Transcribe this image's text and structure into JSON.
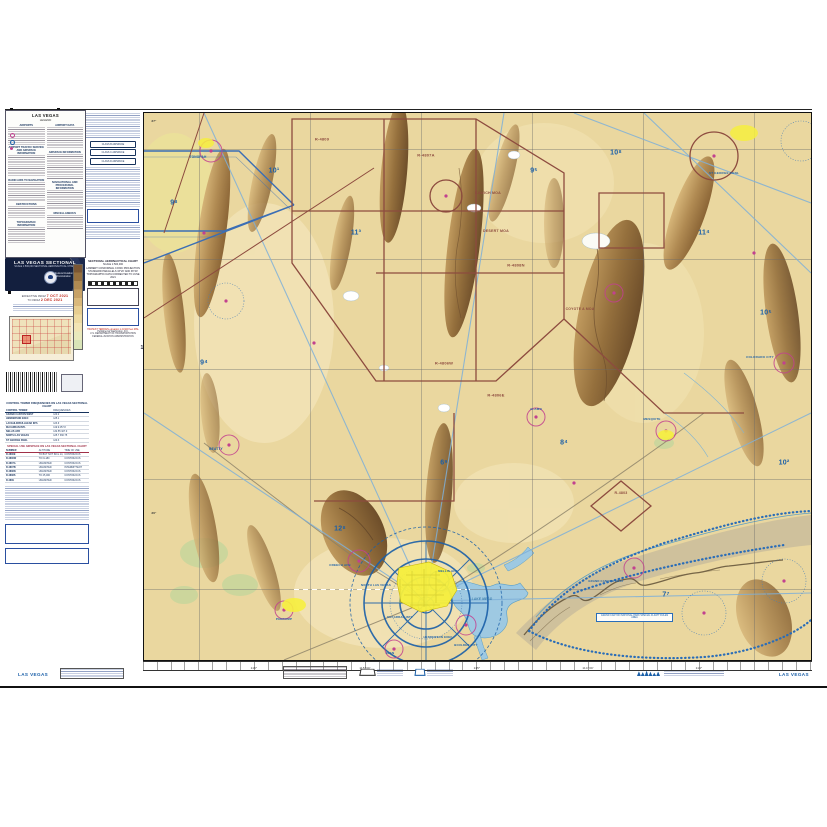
{
  "colors": {
    "maroon": "#8d4b3f",
    "blue": "#1a5fa8",
    "magenta": "#c2418f",
    "water": "#3e7fae",
    "navy": "#131f3e",
    "red": "#c22a1e",
    "yellow": "#f6ef3e"
  },
  "legend": {
    "title": "LAS VEGAS",
    "subtitle": "LEGEND",
    "sections_col1": [
      {
        "h": "AIRPORTS",
        "lines": 8
      },
      {
        "h": "AIRPORT TRAFFIC SERVICE AND AIRSPACE INFORMATION",
        "lines": 10
      },
      {
        "h": "RADIO AIDS TO NAVIGATION",
        "lines": 9
      },
      {
        "h": "OBSTRUCTIONS",
        "lines": 6
      },
      {
        "h": "TOPOGRAPHIC INFORMATION",
        "lines": 8
      }
    ],
    "sections_col2": [
      {
        "h": "AIRPORT DATA",
        "lines": 10
      },
      {
        "h": "AIRSPACE INFORMATION",
        "lines": 12
      },
      {
        "h": "NAVIGATIONAL AND PROCEDURAL INFORMATION",
        "lines": 9
      },
      {
        "h": "MISCELLANEOUS",
        "lines": 7
      }
    ]
  },
  "col2": {
    "box_labels": [
      "CLASS B AIRSPACE",
      "CLASS C AIRSPACE",
      "CLASS D AIRSPACE"
    ]
  },
  "banner": {
    "title": "LAS VEGAS SECTIONAL",
    "subtitle": "SCALE 1:500,000  SECTIONAL AERONAUTICAL CHART",
    "org": "Federal Aviation Administration"
  },
  "effective": {
    "line1_prefix": "EFFECTIVE 0901Z",
    "date1": "7 OCT 2021",
    "line2_prefix": "TO 0901Z",
    "date2": "2 DEC 2021"
  },
  "scale_block": {
    "lines": [
      "SECTIONAL AERONAUTICAL CHART",
      "SCALE 1:500,000",
      "LAMBERT CONFORMAL CONIC PROJECTION",
      "STANDARD PARALLELS 33°20' AND 38°40'",
      "TOPOGRAPHIC DATA CORRECTED TO JUNE 2021"
    ],
    "highest_terrain": "HIGHEST TERRAIN elevation is 11918 feet MSL",
    "publisher": [
      "Published at Washington, D.C.",
      "U.S. DEPARTMENT OF TRANSPORTATION",
      "FEDERAL AVIATION ADMINISTRATION"
    ],
    "isogonic": "12°"
  },
  "tables": {
    "ctaf_title": "CONTROL TOWER FREQUENCIES ON LAS VEGAS SECTIONAL CHART",
    "ctaf_cols": [
      "CONTROL TOWER",
      "FREQUENCIES"
    ],
    "ctaf_rows": [
      [
        "GRAND CANYON WEST",
        "120.2"
      ],
      [
        "HENDERSON EXEC",
        "125.1"
      ],
      [
        "LAUGHLIN/BULLHEAD INTL",
        "123.9"
      ],
      [
        "McCARRAN INTL",
        "119.9 257.8"
      ],
      [
        "NELLIS AFB",
        "132.55 327.0"
      ],
      [
        "NORTH LAS VEGAS",
        "125.7 360.75"
      ],
      [
        "ST GEORGE RGNL",
        "120.3"
      ]
    ],
    "sua_title": "SPECIAL USE AIRSPACE ON LAS VEGAS SECTIONAL CHART",
    "sua_cols": [
      "NUMBER",
      "ALTITUDE",
      "TIME OF USE"
    ],
    "sua_rows": [
      [
        "R-4806E",
        "TO BUT NOT INCL 14,000",
        "CONTINUOUS"
      ],
      [
        "R-4806W",
        "TO FL180",
        "CONTINUOUS"
      ],
      [
        "R-4807A",
        "UNLIMITED",
        "CONTINUOUS"
      ],
      [
        "R-4807B",
        "UNLIMITED",
        "INTERMITTENT"
      ],
      [
        "R-4808N",
        "UNLIMITED",
        "CONTINUOUS"
      ],
      [
        "R-4808S",
        "TO 25,000",
        "CONTINUOUS"
      ],
      [
        "R-4809",
        "UNLIMITED",
        "CONTINUOUS"
      ]
    ]
  },
  "map": {
    "gc_note": "GRAND CANYON NATIONAL PARK SPECIAL FLIGHT RULES AREA",
    "labels": [
      {
        "t": "R-4809",
        "x": 178,
        "y": 26,
        "c": "maroon",
        "s": 4
      },
      {
        "t": "R-4807A",
        "x": 282,
        "y": 42,
        "c": "maroon",
        "s": 4
      },
      {
        "t": "KAWICH MOA",
        "x": 344,
        "y": 80,
        "c": "maroon",
        "s": 3.6
      },
      {
        "t": "DESERT MOA",
        "x": 352,
        "y": 118,
        "c": "maroon",
        "s": 3.6
      },
      {
        "t": "R-4808N",
        "x": 372,
        "y": 152,
        "c": "maroon",
        "s": 4
      },
      {
        "t": "R-4806W",
        "x": 300,
        "y": 250,
        "c": "maroon",
        "s": 4
      },
      {
        "t": "R-4806E",
        "x": 352,
        "y": 282,
        "c": "maroon",
        "s": 4
      },
      {
        "t": "COYOTE A MOA",
        "x": 436,
        "y": 196,
        "c": "maroon",
        "s": 3.4
      },
      {
        "t": "R-4803",
        "x": 477,
        "y": 380,
        "c": "maroon",
        "s": 3.6
      },
      {
        "t": "TONOPAH",
        "x": 54,
        "y": 44,
        "c": "blue",
        "s": 3.2
      },
      {
        "t": "BEATTY",
        "x": 72,
        "y": 336,
        "c": "blue",
        "s": 3.2
      },
      {
        "t": "CREECH AFB",
        "x": 196,
        "y": 452,
        "c": "blue",
        "s": 3
      },
      {
        "t": "NELLIS AFB",
        "x": 304,
        "y": 458,
        "c": "blue",
        "s": 3
      },
      {
        "t": "NORTH LAS VEGAS",
        "x": 232,
        "y": 472,
        "c": "blue",
        "s": 2.8
      },
      {
        "t": "McCARRAN INTL",
        "x": 256,
        "y": 504,
        "c": "blue",
        "s": 2.8
      },
      {
        "t": "HENDERSON EXEC",
        "x": 294,
        "y": 524,
        "c": "blue",
        "s": 2.8
      },
      {
        "t": "BOULDER CITY",
        "x": 322,
        "y": 532,
        "c": "blue",
        "s": 2.8
      },
      {
        "t": "JEAN",
        "x": 246,
        "y": 540,
        "c": "blue",
        "s": 3
      },
      {
        "t": "PAHRUMP",
        "x": 140,
        "y": 506,
        "c": "blue",
        "s": 3
      },
      {
        "t": "MESQUITE",
        "x": 508,
        "y": 306,
        "c": "blue",
        "s": 3
      },
      {
        "t": "ST GEORGE RGNL",
        "x": 580,
        "y": 60,
        "c": "blue",
        "s": 3
      },
      {
        "t": "COLORADO CITY",
        "x": 616,
        "y": 244,
        "c": "blue",
        "s": 3
      },
      {
        "t": "GRAND CANYON WEST",
        "x": 462,
        "y": 468,
        "c": "blue",
        "s": 2.8
      },
      {
        "t": "ALAMO",
        "x": 392,
        "y": 296,
        "c": "blue",
        "s": 3
      },
      {
        "t": "LAKE MEAD",
        "x": 338,
        "y": 486,
        "c": "water",
        "s": 3.2,
        "i": 1
      },
      {
        "t": "9⁸",
        "x": 30,
        "y": 90,
        "c": "blue",
        "s": 7
      },
      {
        "t": "10¹",
        "x": 130,
        "y": 58,
        "c": "blue",
        "s": 7
      },
      {
        "t": "11³",
        "x": 212,
        "y": 120,
        "c": "blue",
        "s": 7
      },
      {
        "t": "9⁵",
        "x": 390,
        "y": 58,
        "c": "blue",
        "s": 7
      },
      {
        "t": "10⁸",
        "x": 472,
        "y": 40,
        "c": "blue",
        "s": 7
      },
      {
        "t": "11⁴",
        "x": 560,
        "y": 120,
        "c": "blue",
        "s": 7
      },
      {
        "t": "10⁵",
        "x": 622,
        "y": 200,
        "c": "blue",
        "s": 7
      },
      {
        "t": "12⁸",
        "x": 196,
        "y": 416,
        "c": "blue",
        "s": 7
      },
      {
        "t": "9⁴",
        "x": 60,
        "y": 250,
        "c": "blue",
        "s": 7
      },
      {
        "t": "8⁴",
        "x": 420,
        "y": 330,
        "c": "blue",
        "s": 7
      },
      {
        "t": "7⁷",
        "x": 522,
        "y": 482,
        "c": "blue",
        "s": 7
      },
      {
        "t": "10²",
        "x": 640,
        "y": 350,
        "c": "blue",
        "s": 7
      },
      {
        "t": "6⁹",
        "x": 300,
        "y": 350,
        "c": "blue",
        "s": 7
      },
      {
        "t": "37°",
        "x": 10,
        "y": 8,
        "c": "#333",
        "s": 3
      },
      {
        "t": "36°",
        "x": 10,
        "y": 400,
        "c": "#333",
        "s": 3
      }
    ]
  },
  "margin": {
    "title_left": "LAS VEGAS",
    "title_right": "LAS VEGAS",
    "lon_labels": [
      {
        "t": "116°",
        "x": 111,
        "y": 4,
        "c": "#333",
        "s": 3
      },
      {
        "t": "115°30'",
        "x": 222,
        "y": 4,
        "c": "#333",
        "s": 3
      },
      {
        "t": "115°",
        "x": 334,
        "y": 4,
        "c": "#333",
        "s": 3
      },
      {
        "t": "114°30'",
        "x": 445,
        "y": 4,
        "c": "#333",
        "s": 3
      },
      {
        "t": "114°",
        "x": 556,
        "y": 4,
        "c": "#333",
        "s": 3
      }
    ]
  }
}
